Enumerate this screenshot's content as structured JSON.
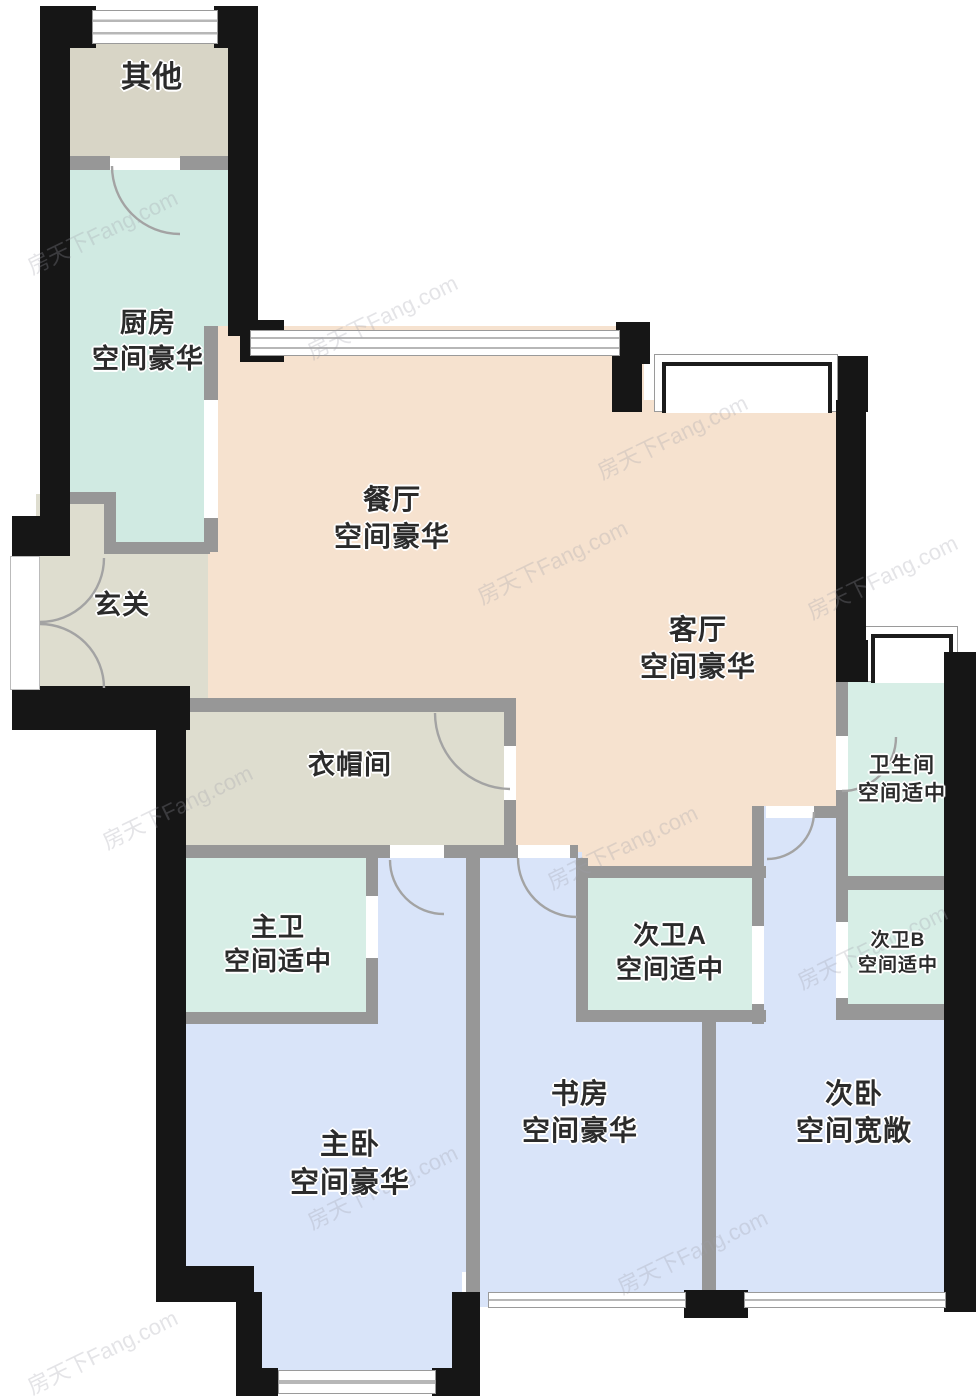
{
  "palette": {
    "exterior_wall": "#161616",
    "interior_wall": "#979797",
    "room_other": "#d8d5c6",
    "room_kitchen": "#d0eae2",
    "room_bathroom": "#d7eee6",
    "room_living_dining": "#f6e2cf",
    "room_hallway": "#deddcf",
    "room_bedroom": "#d9e4f9",
    "window": "#ffffff"
  },
  "watermark": {
    "text": "房天下Fang.com"
  },
  "rooms": [
    {
      "id": "other",
      "name": "其他",
      "desc": ""
    },
    {
      "id": "kitchen",
      "name": "厨房",
      "desc": "空间豪华"
    },
    {
      "id": "dining",
      "name": "餐厅",
      "desc": "空间豪华"
    },
    {
      "id": "living",
      "name": "客厅",
      "desc": "空间豪华"
    },
    {
      "id": "entry",
      "name": "玄关",
      "desc": ""
    },
    {
      "id": "cloakroom",
      "name": "衣帽间",
      "desc": ""
    },
    {
      "id": "master-bath",
      "name": "主卫",
      "desc": "空间适中"
    },
    {
      "id": "bath-a",
      "name": "次卫A",
      "desc": "空间适中"
    },
    {
      "id": "bathroom",
      "name": "卫生间",
      "desc": "空间适中"
    },
    {
      "id": "bath-b",
      "name": "次卫B",
      "desc": "空间适中"
    },
    {
      "id": "master-bedroom",
      "name": "主卧",
      "desc": "空间豪华"
    },
    {
      "id": "study",
      "name": "书房",
      "desc": "空间豪华"
    },
    {
      "id": "second-bedroom",
      "name": "次卧",
      "desc": "空间宽敞"
    }
  ]
}
